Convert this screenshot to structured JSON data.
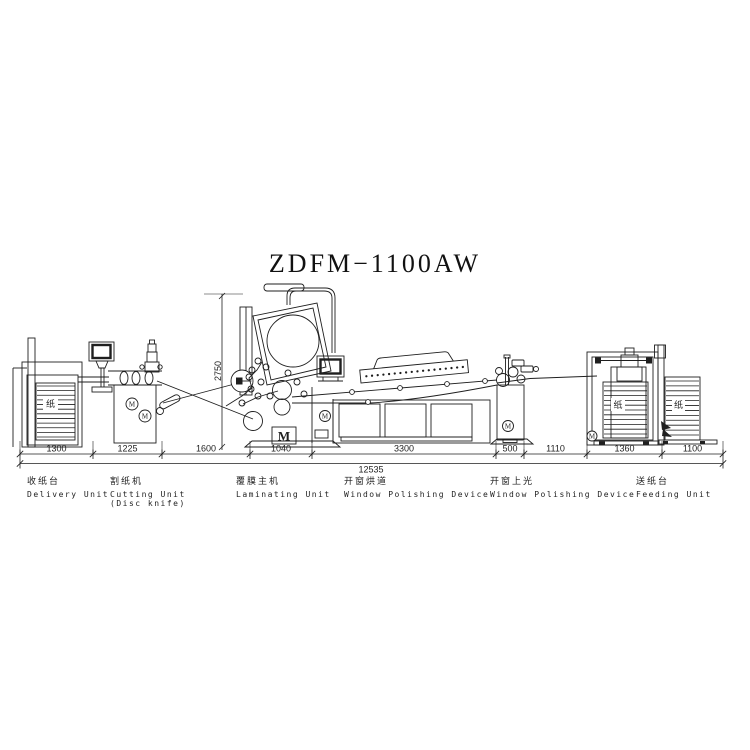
{
  "title": "ZDFM−1100AW",
  "dimensions": {
    "total": "12535",
    "height": "2750",
    "segments": [
      {
        "name": "delivery-width",
        "value": "1300"
      },
      {
        "name": "cutting-width",
        "value": "1225"
      },
      {
        "name": "gap1-width",
        "value": "1600"
      },
      {
        "name": "laminating-width",
        "value": "1040"
      },
      {
        "name": "tunnel-width",
        "value": "3300"
      },
      {
        "name": "polishing-width",
        "value": "500"
      },
      {
        "name": "gap2-width",
        "value": "1110"
      },
      {
        "name": "feeding-width",
        "value": "1360"
      },
      {
        "name": "stack-width",
        "value": "1100"
      }
    ]
  },
  "units": [
    {
      "cn": "收纸台",
      "en": "Delivery Unit",
      "sub": ""
    },
    {
      "cn": "割纸机",
      "en": "Cutting Unit",
      "sub": "(Disc knife)"
    },
    {
      "cn": "覆膜主机",
      "en": "Laminating Unit",
      "sub": ""
    },
    {
      "cn": "开窗烘道",
      "en": "Window Polishing Device",
      "sub": ""
    },
    {
      "cn": "开窗上光",
      "en": "Window Polishing Device",
      "sub": ""
    },
    {
      "cn": "送纸台",
      "en": "Feeding Unit",
      "sub": ""
    }
  ],
  "glyphs": {
    "paper": "纸",
    "motor": "M"
  },
  "colors": {
    "line": "#1f1f1f",
    "background": "#ffffff"
  }
}
